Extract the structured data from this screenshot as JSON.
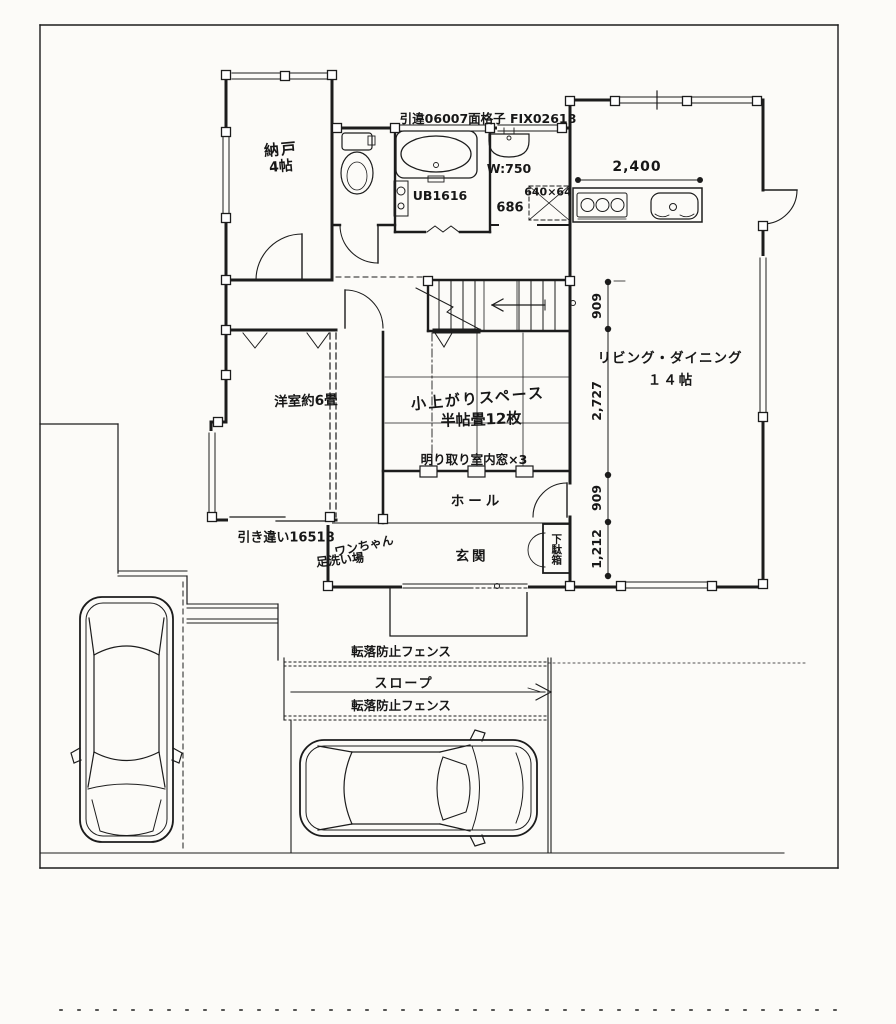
{
  "rooms": {
    "nando": {
      "name": "納戸",
      "size": "4帖"
    },
    "bath": "UB1616",
    "wash": "W:750",
    "living": {
      "name": "リビング・ダイニング",
      "size": "１４帖"
    },
    "western": "洋室約6畳",
    "tatami": {
      "line1": "小上がりスペース",
      "line2": "半帖畳12枚"
    },
    "hall": "ホール",
    "entrance": "玄関",
    "shoe_cabinet": "下駄箱",
    "dog_wash": {
      "line1": "ワンちゃん",
      "line2": "足洗い場"
    }
  },
  "annotations": {
    "top_windows": "引違06007面格子  FIX02618",
    "hatch": "640×64",
    "wash_width": "686",
    "interior_windows": "明り取り室内窓×3",
    "sliding_window": "引き違い16518",
    "fence_upper": "転落防止フェンス",
    "slope": "スロープ",
    "fence_lower": "転落防止フェンス"
  },
  "dimensions": {
    "kitchen_width": "2,400",
    "right_chain": [
      "909",
      "2,727",
      "909",
      "1,212"
    ]
  },
  "colors": {
    "line": "#1c1c1c",
    "paper": "#fcfbf8"
  }
}
